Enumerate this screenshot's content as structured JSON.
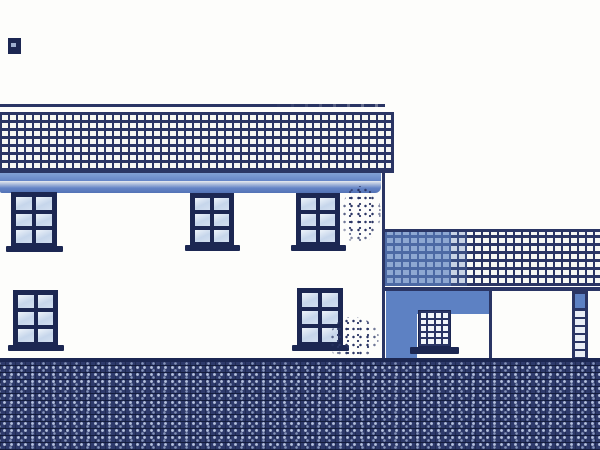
{
  "drawing": {
    "kind": "scanned architectural side-elevation drawing, blue ink on white paper",
    "visible_text": "none"
  },
  "colors": {
    "paper": "#fdfdfb",
    "ink": "#2a3564",
    "ink_dark": "#1c2752",
    "fascia": "#6484c6",
    "pane": "#c6d6eb",
    "bay": "#5d81c3",
    "ground": "#2e3a6b",
    "ground_dot": "#b7c3e0"
  },
  "windows": {
    "main": {
      "cols": 2,
      "rows": 3
    },
    "outbuilding": {
      "cols": 4,
      "rows": 5
    }
  },
  "elements": [
    "scan-mark top-left",
    "main roof ridge line",
    "main cross-hatched roof",
    "blue fascia band",
    "three upper six-pane windows",
    "two lower six-pane windows",
    "two stipple texture patches",
    "main wall corner line",
    "outbuilding hatched roof with blue shadow wash",
    "outbuilding shadowed bay with small multi-pane window",
    "open white bay",
    "rung-patterned pillar at right edge",
    "dark hatched ground band"
  ]
}
